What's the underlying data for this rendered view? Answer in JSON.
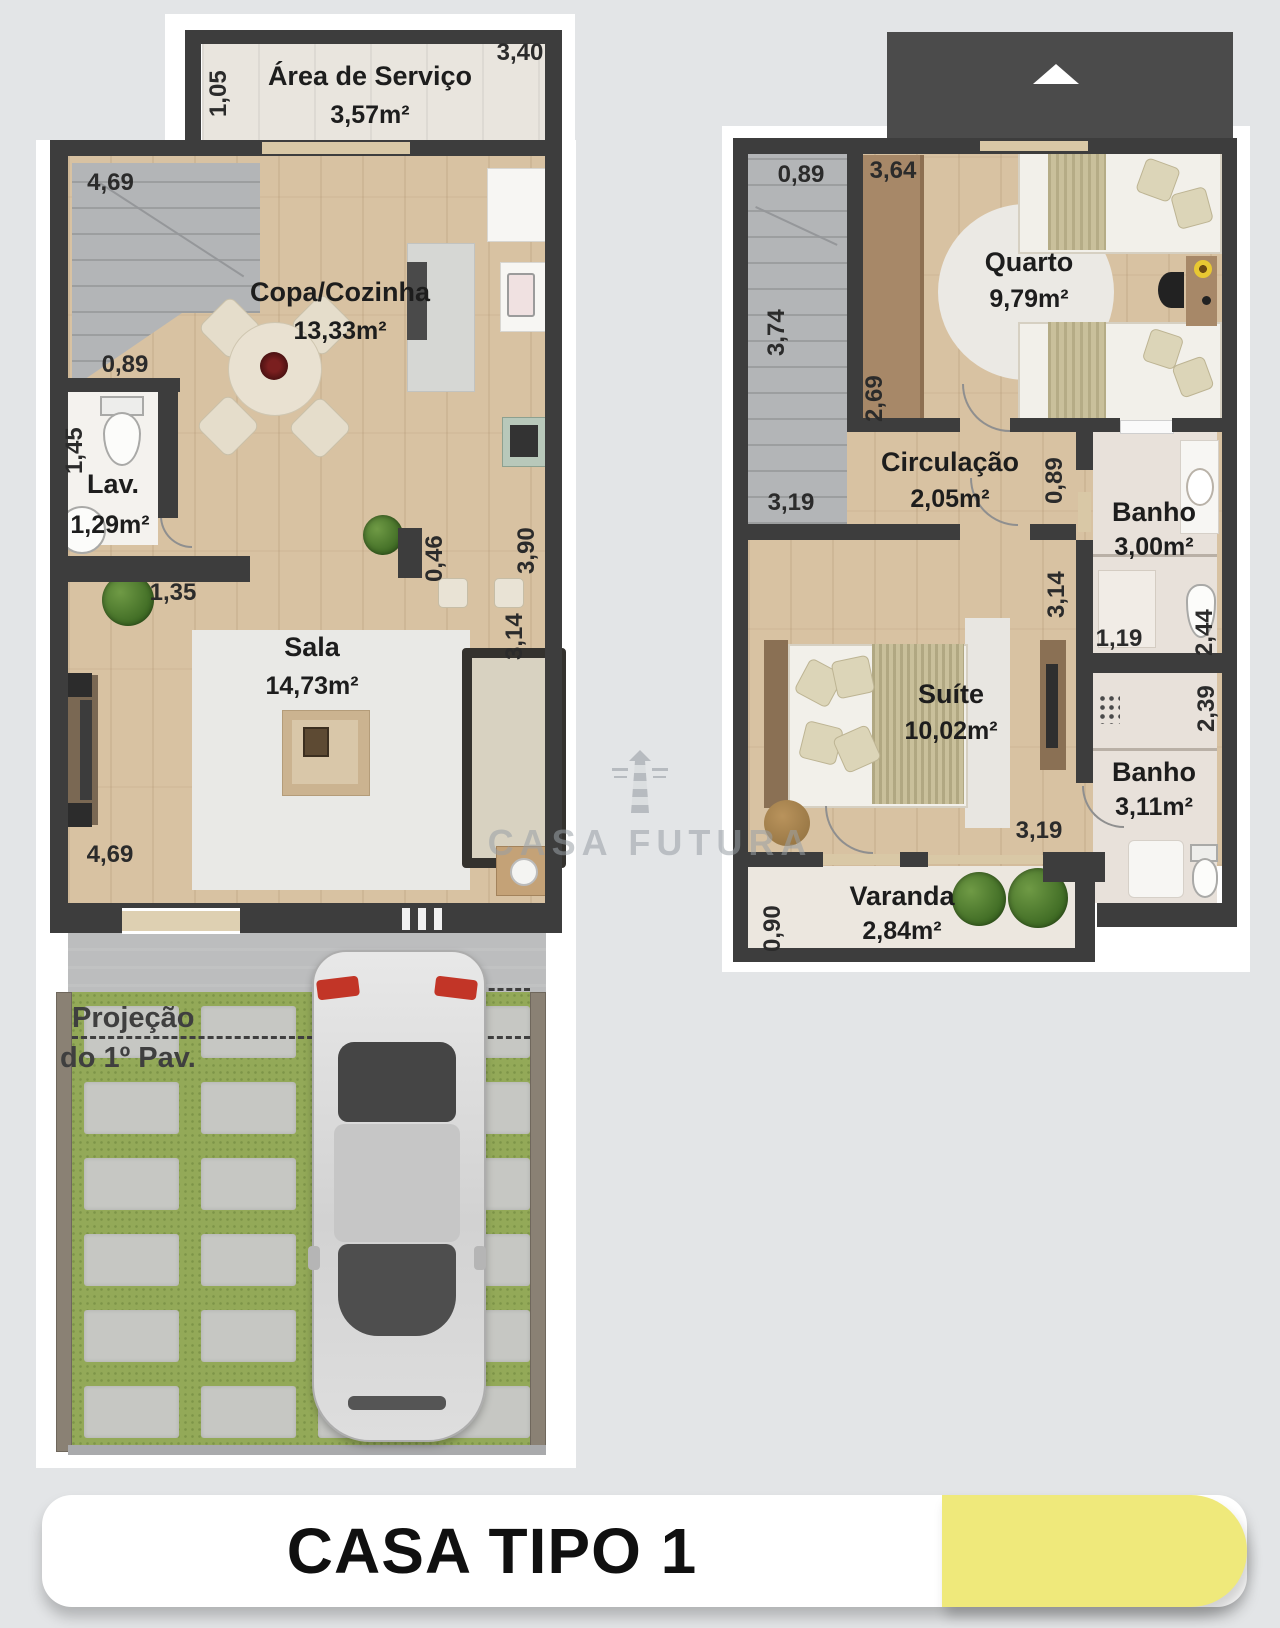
{
  "banner": {
    "title": "CASA TIPO 1",
    "accent_yellow": "#efe97b"
  },
  "watermark": {
    "text": "CASA FUTURA",
    "icon": "lighthouse-icon"
  },
  "colors": {
    "wall": "#3d3d3d",
    "wood_floor": "#d8c2a2",
    "grass": "#93a958",
    "stair_gray": "#b3b5b7"
  },
  "ground_floor": {
    "servico": {
      "name": "Área de Serviço",
      "area": "3,57m²",
      "dim_side": "1,05",
      "dim_width": "3,40"
    },
    "stair_dim": "4,69",
    "copa": {
      "name": "Copa/Cozinha",
      "area": "13,33m²"
    },
    "lav": {
      "name": "Lav.",
      "area": "1,29m²",
      "dim_door": "0,89",
      "dim_depth": "1,45",
      "dim_width": "1,35"
    },
    "sala": {
      "name": "Sala",
      "area": "14,73m²",
      "dim_tv": "0,46",
      "dim_right_upper": "3,90",
      "dim_right_lower": "3,14",
      "dim_width": "4,69"
    },
    "garage": {
      "note_line1": "Projeção",
      "note_line2": "do 1º Pav."
    }
  },
  "upper_floor": {
    "stair": {
      "dim_top": "0,89",
      "dim_side": "3,74",
      "dim_bottom": "3,19"
    },
    "quarto": {
      "name": "Quarto",
      "area": "9,79m²",
      "dim_top": "3,64",
      "dim_side": "2,69"
    },
    "circulacao": {
      "name": "Circulação",
      "area": "2,05m²",
      "dim_door": "0,89"
    },
    "banho_superior": {
      "name": "Banho",
      "area": "3,00m²",
      "dim_width": "1,19",
      "dim_side": "2,44"
    },
    "suite": {
      "name": "Suíte",
      "area": "10,02m²",
      "dim_wall": "3,14",
      "dim_bottom": "3,19"
    },
    "banho_suite": {
      "name": "Banho",
      "area": "3,11m²",
      "dim_side": "2,39"
    },
    "varanda": {
      "name": "Varanda",
      "area": "2,84m²",
      "dim_side": "0,90"
    }
  }
}
